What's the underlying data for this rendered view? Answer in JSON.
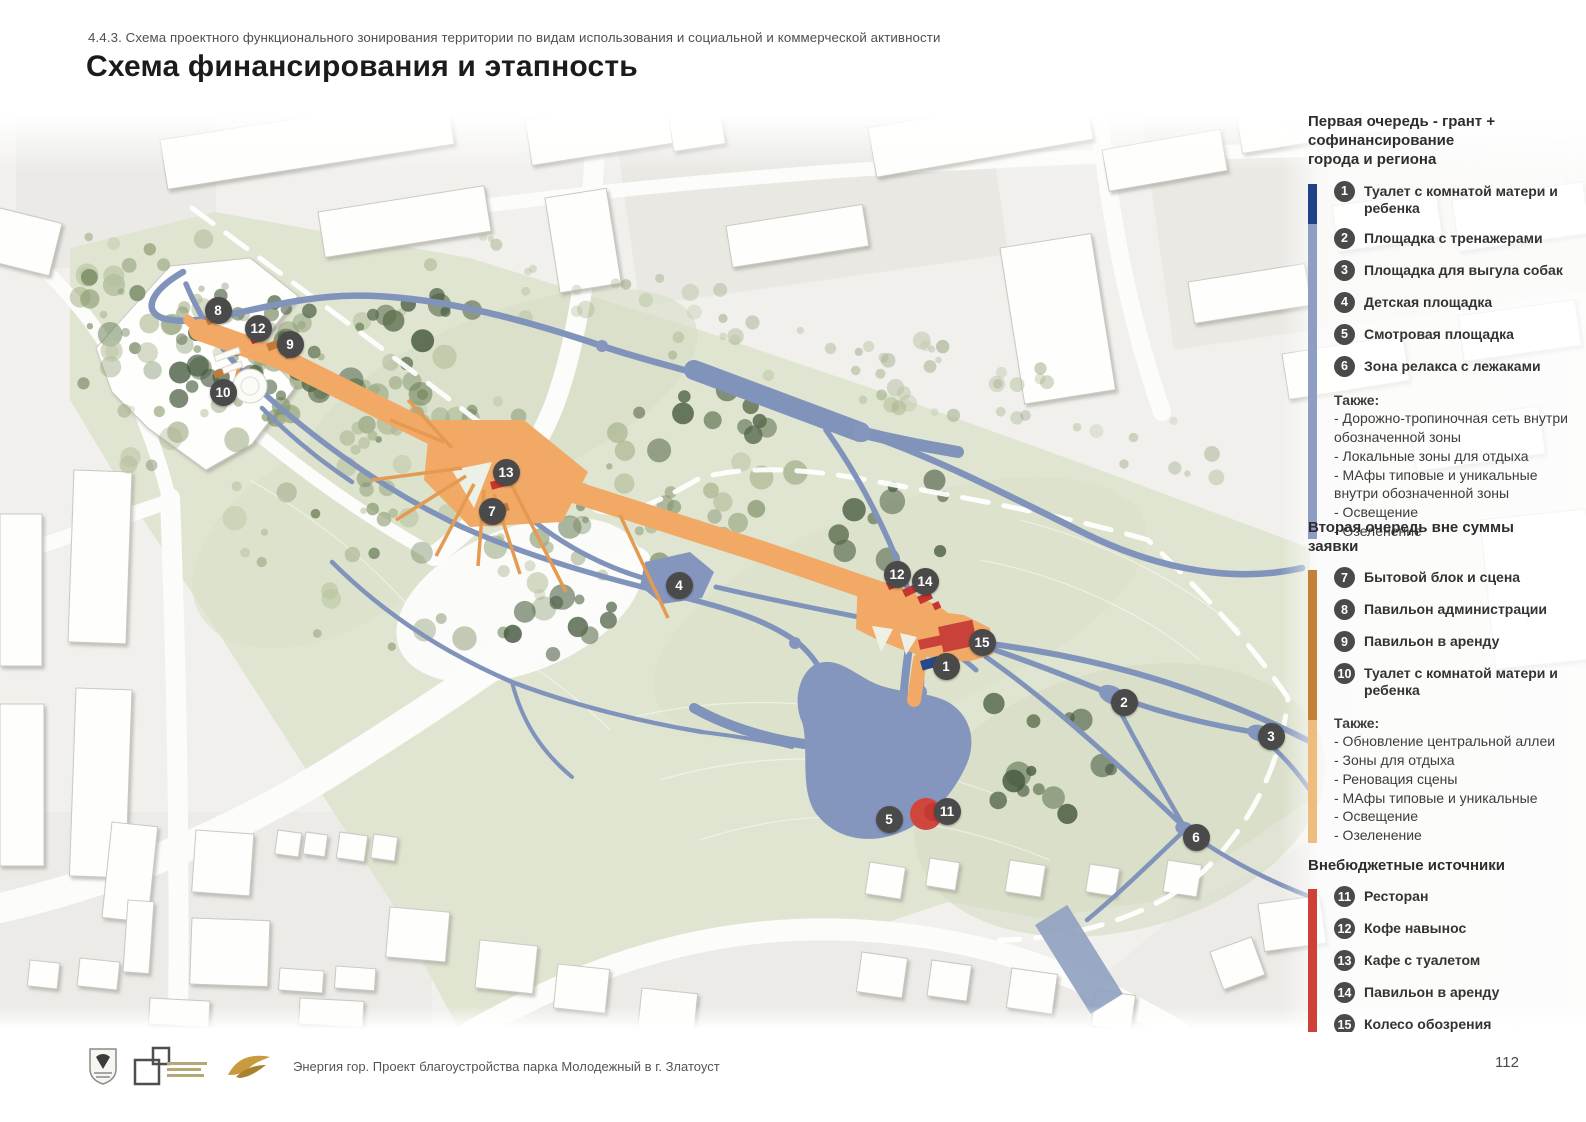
{
  "page": {
    "kicker": "4.4.3. Схема проектного функционального зонирования территории по видам использования и социальной и коммерческой активности",
    "title": "Схема финансирования  и этапность",
    "page_number": "112",
    "footer_caption": "Энергия гор. Проект благоустройства парка Молодежный в г. Златоуст"
  },
  "legend": {
    "marker_color": "#4a4a4a",
    "sections": [
      {
        "title": "Первая очередь - грант +\nсофинансирование\nгорода и региона",
        "bar_colors": [
          "#1e4187",
          "#8e9dc4"
        ],
        "items": [
          {
            "num": "1",
            "label": "Туалет с комнатой матери и ребенка"
          },
          {
            "num": "2",
            "label": "Площадка с тренажерами"
          },
          {
            "num": "3",
            "label": "Площадка для выгула собак"
          },
          {
            "num": "4",
            "label": "Детская площадка"
          },
          {
            "num": "5",
            "label": "Смотровая площадка"
          },
          {
            "num": "6",
            "label": "Зона релакса с лежаками"
          }
        ],
        "also_title": "Также:",
        "also_items": [
          "- Дорожно-тропиночная сеть внутри обозначенной зоны",
          "- Локальные зоны для отдыха",
          "- МАфы типовые и уникальные внутри обозначенной зоны",
          "- Освещение",
          "- Озеленение"
        ]
      },
      {
        "title": "Вторая очередь вне суммы\nзаявки",
        "bar_colors": [
          "#c28136",
          "#eebc7c"
        ],
        "items": [
          {
            "num": "7",
            "label": "Бытовой блок и сцена"
          },
          {
            "num": "8",
            "label": "Павильон администрации"
          },
          {
            "num": "9",
            "label": "Павильон в аренду"
          },
          {
            "num": "10",
            "label": "Туалет с комнатой матери и ребенка"
          }
        ],
        "also_title": "Также:",
        "also_items": [
          "- Обновление центральной аллеи",
          "- Зоны для отдыха",
          "- Реновация сцены",
          "- МАфы типовые и уникальные",
          "- Освещение",
          "- Озеленение"
        ]
      },
      {
        "title": "Внебюджетные источники",
        "bar_colors": [
          "#cf4038"
        ],
        "items": [
          {
            "num": "11",
            "label": "Ресторан"
          },
          {
            "num": "12",
            "label": "Кофе навынос"
          },
          {
            "num": "13",
            "label": "Кафе с туалетом"
          },
          {
            "num": "14",
            "label": "Павильон в аренду"
          },
          {
            "num": "15",
            "label": "Колесо обозрения"
          }
        ],
        "also_title": "",
        "also_items": []
      }
    ]
  },
  "map": {
    "colors": {
      "alley_orange": "#f2a966",
      "path_blue": "#8093ba",
      "phase1_blue": "#1e4187",
      "phase2_ochre": "#c28136",
      "offbudget_red": "#cf4038",
      "park_green": "#e0e5d1"
    },
    "markers": [
      {
        "num": "8",
        "x": 218,
        "y": 310
      },
      {
        "num": "12",
        "x": 258,
        "y": 328
      },
      {
        "num": "9",
        "x": 290,
        "y": 344
      },
      {
        "num": "10",
        "x": 223,
        "y": 392
      },
      {
        "num": "13",
        "x": 506,
        "y": 472
      },
      {
        "num": "7",
        "x": 492,
        "y": 511
      },
      {
        "num": "4",
        "x": 679,
        "y": 585
      },
      {
        "num": "12",
        "x": 897,
        "y": 574
      },
      {
        "num": "14",
        "x": 925,
        "y": 581
      },
      {
        "num": "15",
        "x": 982,
        "y": 642
      },
      {
        "num": "1",
        "x": 946,
        "y": 666
      },
      {
        "num": "2",
        "x": 1124,
        "y": 702
      },
      {
        "num": "3",
        "x": 1271,
        "y": 736
      },
      {
        "num": "5",
        "x": 889,
        "y": 819
      },
      {
        "num": "11",
        "x": 947,
        "y": 811
      },
      {
        "num": "6",
        "x": 1196,
        "y": 837
      }
    ]
  }
}
